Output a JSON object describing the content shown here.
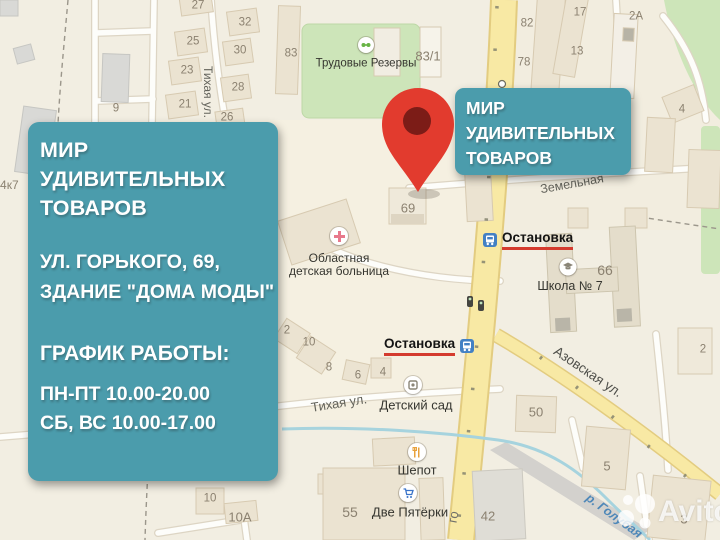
{
  "info_card": {
    "title_lines": [
      "МИР",
      "УДИВИТЕЛЬНЫХ",
      "ТОВАРОВ"
    ],
    "address_lines": [
      "УЛ. ГОРЬКОГО, 69,",
      "ЗДАНИЕ \"ДОМА МОДЫ\""
    ],
    "schedule_heading": "ГРАФИК РАБОТЫ:",
    "schedule_lines": [
      "ПН-ПТ 10.00-20.00",
      "СБ, ВС 10.00-17.00"
    ]
  },
  "callout": {
    "lines": [
      "МИР",
      "УДИВИТЕЛЬНЫХ",
      "ТОВАРОВ"
    ]
  },
  "map": {
    "stop_label": "Остановка",
    "watermark": "Avito",
    "streets": {
      "tihaya_vertical": "Тихая ул.",
      "tihaya_bottom": "Тихая ул.",
      "zemelnaya": "Земельная",
      "azovskaya": "Азовская ул.",
      "gorkogo_fragment": "го",
      "river": "р. Голубая"
    },
    "pois": {
      "trudovye": "Трудовые Резервы",
      "hospital_line1": "Областная",
      "hospital_line2": "детская больница",
      "school": "Школа № 7",
      "kindergarten": "Детский сад",
      "shepot": "Шепот",
      "pyaterki": "Две Пятёрки"
    },
    "house_numbers": [
      {
        "t": "27",
        "x": 198,
        "y": 6
      },
      {
        "t": "32",
        "x": 245,
        "y": 23
      },
      {
        "t": "25",
        "x": 193,
        "y": 42
      },
      {
        "t": "30",
        "x": 240,
        "y": 51
      },
      {
        "t": "23",
        "x": 187,
        "y": 71
      },
      {
        "t": "28",
        "x": 238,
        "y": 88
      },
      {
        "t": "21",
        "x": 185,
        "y": 105
      },
      {
        "t": "26",
        "x": 227,
        "y": 118
      },
      {
        "t": "9",
        "x": 116,
        "y": 109
      },
      {
        "t": "83",
        "x": 291,
        "y": 54
      },
      {
        "t": "83/1",
        "x": 428,
        "y": 56,
        "size": 13
      },
      {
        "t": "82",
        "x": 527,
        "y": 24
      },
      {
        "t": "78",
        "x": 524,
        "y": 63
      },
      {
        "t": "17",
        "x": 580,
        "y": 13
      },
      {
        "t": "13",
        "x": 577,
        "y": 52
      },
      {
        "t": "2А",
        "x": 636,
        "y": 17
      },
      {
        "t": "4",
        "x": 682,
        "y": 110
      },
      {
        "t": "69",
        "x": 408,
        "y": 208,
        "size": 13
      },
      {
        "t": "66",
        "x": 605,
        "y": 270,
        "size": 14
      },
      {
        "t": "2",
        "x": 703,
        "y": 350
      },
      {
        "t": "50",
        "x": 536,
        "y": 412,
        "size": 13
      },
      {
        "t": "5",
        "x": 607,
        "y": 466,
        "size": 13
      },
      {
        "t": "42",
        "x": 488,
        "y": 516,
        "size": 13
      },
      {
        "t": "3",
        "x": 684,
        "y": 519,
        "size": 13
      },
      {
        "t": "2",
        "x": 287,
        "y": 331
      },
      {
        "t": "10",
        "x": 309,
        "y": 343
      },
      {
        "t": "8",
        "x": 329,
        "y": 368
      },
      {
        "t": "6",
        "x": 358,
        "y": 376
      },
      {
        "t": "4",
        "x": 383,
        "y": 373
      },
      {
        "t": "10",
        "x": 210,
        "y": 499
      },
      {
        "t": "10А",
        "x": 240,
        "y": 517,
        "size": 13
      },
      {
        "t": "55",
        "x": 350,
        "y": 512,
        "size": 14
      },
      {
        "t": "64к7",
        "x": 6,
        "y": 185,
        "size": 12
      }
    ],
    "colors": {
      "accent_teal": "#4b9cac",
      "pin_red": "#e23b2e",
      "pin_core": "#7c1c17",
      "stop_underline": "#d43b2e",
      "road_yellow": "#f8e9a4",
      "park_green": "#cde5b9",
      "river_blue": "#a6d3de"
    }
  }
}
